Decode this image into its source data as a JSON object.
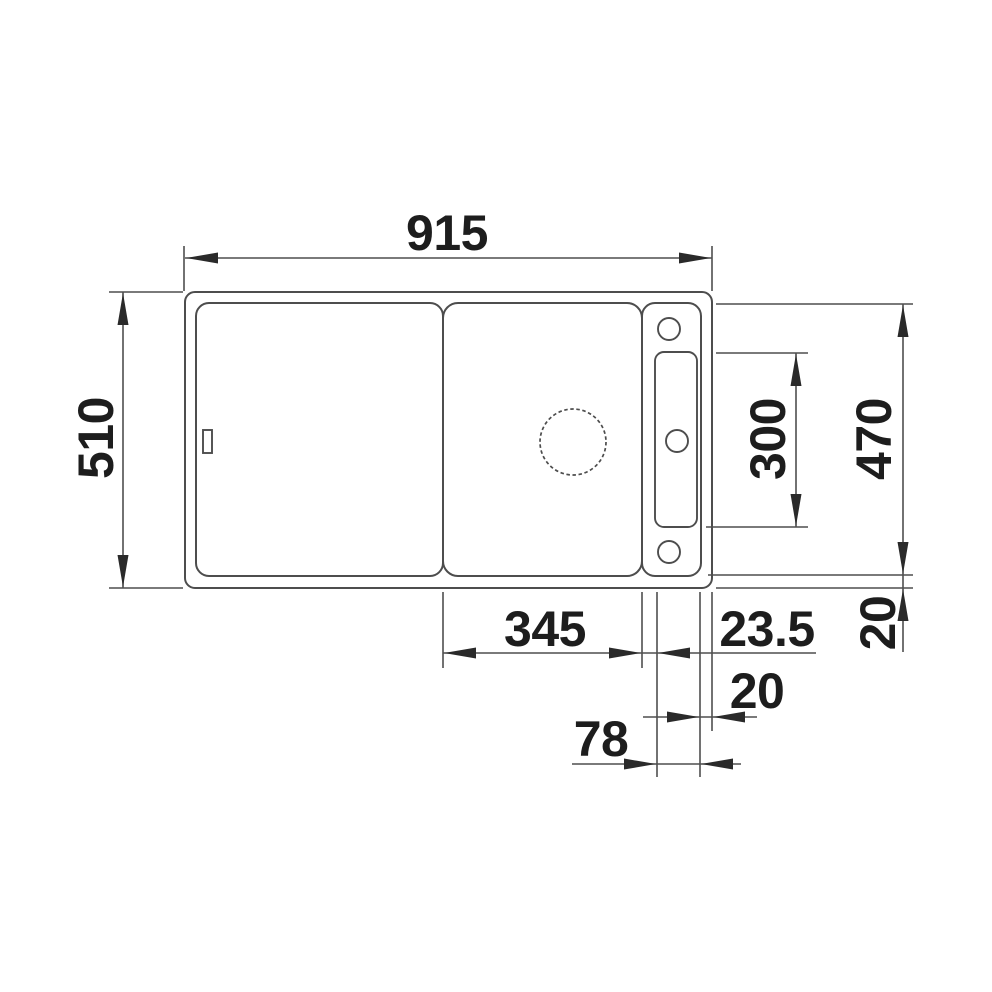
{
  "drawing": {
    "kind": "sink-plan-view-dimension-drawing"
  },
  "dims": {
    "overall_width": "915",
    "overall_depth": "510",
    "inner_depth": "470",
    "rail_slot_length": "300",
    "bowl_width": "345",
    "bowl_rail_gap": "23.5",
    "rim_right": "20",
    "rail_width": "78",
    "rim_bottom": "20"
  },
  "colors": {
    "line": "#4d4d4d",
    "text": "#1d1d1d",
    "background": "#ffffff"
  }
}
